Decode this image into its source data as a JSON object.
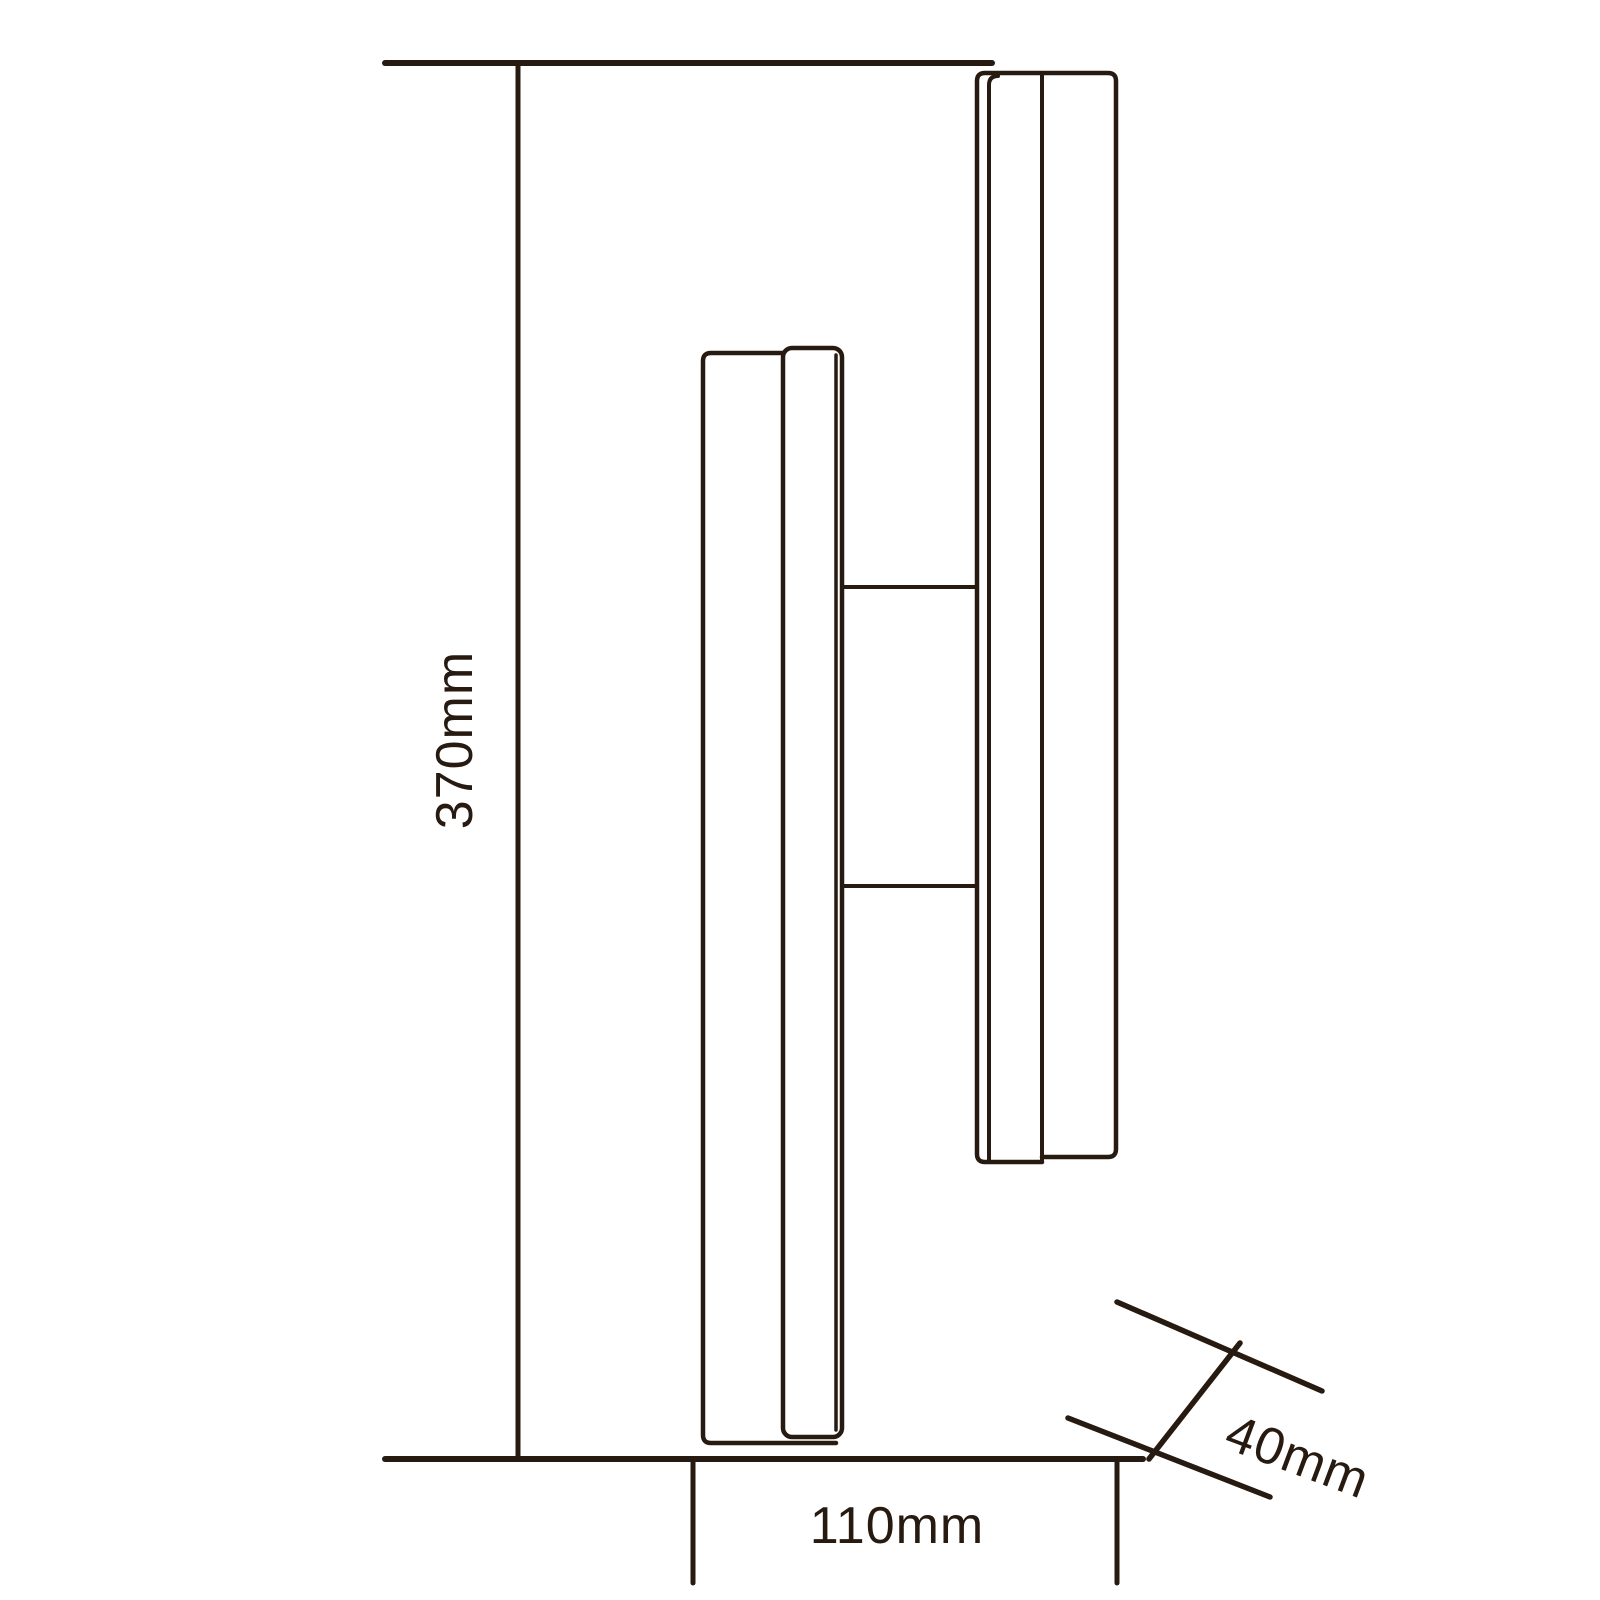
{
  "labels": {
    "height": "370mm",
    "width": "110mm",
    "depth": "40mm"
  },
  "colors": {
    "line": "#271a10",
    "text": "#271a10",
    "background": "#ffffff"
  }
}
